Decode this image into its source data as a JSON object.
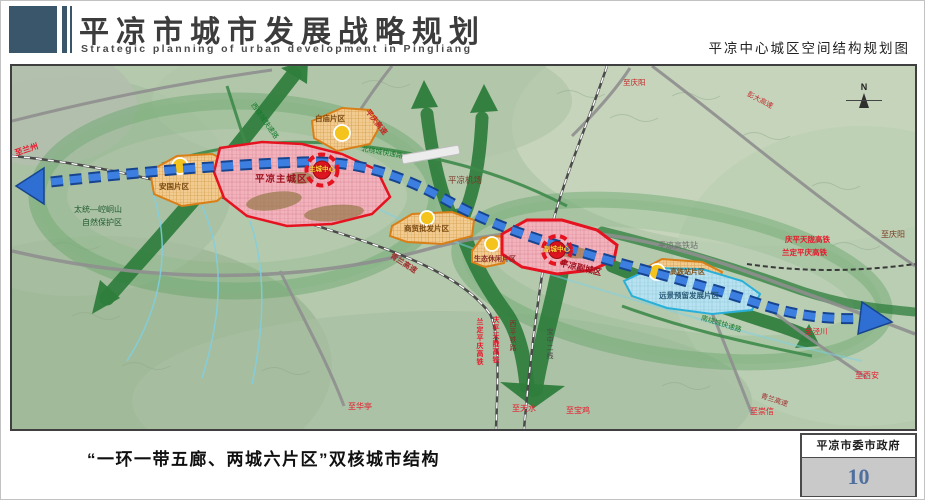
{
  "header": {
    "title": "平凉市城市发展战略规划",
    "title_en": "Strategic planning of urban development in Pingliang",
    "map_title": "平凉中心城区空间结构规划图"
  },
  "map": {
    "compass_n": "N",
    "palette": {
      "axis_blue": "#2f6fd4",
      "corridor_green": "#2e7d3c",
      "core_red": "#e51220",
      "zone_orange": "#d97f18",
      "reserve_blue": "#2ab0d8",
      "terrain_green": "#b5c9ad"
    },
    "labels": {
      "zhi_lanzhou": "至兰州",
      "nature_1": "太统—崆峒山",
      "nature_2": "自然保护区",
      "west_ring": "西绕城快速路",
      "pingqing": "平庆高速",
      "baimiao": "白庙片区",
      "north_ring": "北绕城快速路",
      "qingyang_top": "至庆阳",
      "pengda": "彭大高速",
      "main_city": "平凉主城区",
      "main_center": "主城中心",
      "airport": "平凉机场",
      "anguo": "安国片区",
      "wholesale": "商贸批发片区",
      "qinglan": "青兰高速",
      "leisure": "生态休闲片区",
      "sub_city": "平凉副城区",
      "sub_center": "副城中心",
      "hsr_station": "平凉高铁站",
      "hsr_zone": "高铁站片区",
      "reserve": "远景预留发展片区",
      "south_ring": "南绕城快速路",
      "qingping_hsr": "庆平天陇高铁",
      "landing_hsr": "兰定平庆高铁",
      "qingyang_right": "至庆阳",
      "v_landing": "兰定平庆高铁",
      "v_qingping": "庆平天陇高铁",
      "v_xiping": "西平铁路",
      "v_baozhong": "宝中二线",
      "zhi_huating": "至华亭",
      "zhi_tianshui": "至天水",
      "zhi_baoji": "至宝鸡",
      "zhi_chongxin": "至崇信",
      "zhi_xian": "至西安",
      "zhi_jingchuan": "至泾川",
      "qinglan_2": "青兰高速"
    }
  },
  "footer": {
    "caption": "“一环一带五廊、两城六片区”双核城市结构",
    "org": "平凉市委市政府",
    "page_number": "10"
  }
}
